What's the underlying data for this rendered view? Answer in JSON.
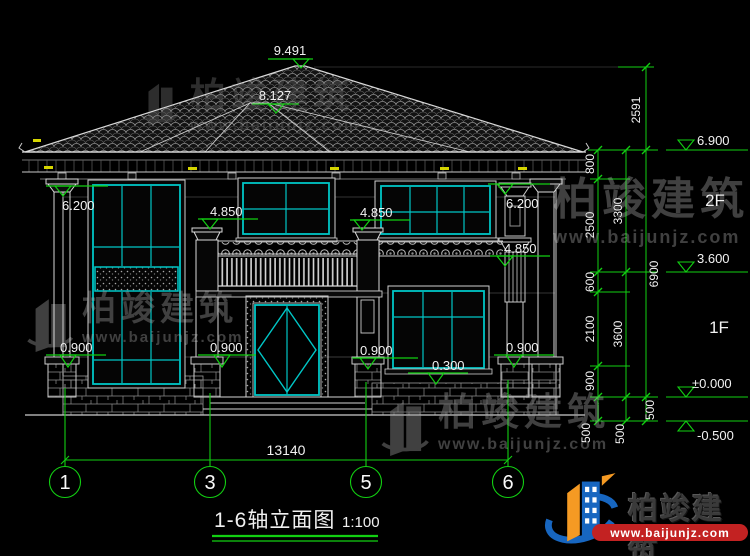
{
  "colors": {
    "background": "#000000",
    "line_white": "#d9d9d9",
    "cad_green": "#12cf12",
    "cad_cyan": "#00c6c6",
    "cad_yellow": "#d6d600",
    "watermark_gray": "#4b4b4b",
    "logo_red": "#c32222",
    "logo_blue": "#1766c0",
    "logo_orange": "#f59a23"
  },
  "roof_markers": {
    "ridge": "9.491",
    "porch_ridge": "8.127"
  },
  "level_markers": {
    "eave_left": "6.200",
    "eave_right": "6.200",
    "balcony_left": "4.850",
    "balcony_mid": "4.850",
    "balcony_right": "4.850",
    "base_1": "0.900",
    "base_2": "0.900",
    "base_3": "0.900",
    "base_4": "0.900",
    "sill": "0.300"
  },
  "right_dims": {
    "roof_height": "2591",
    "col1": [
      "800",
      "2500",
      "600",
      "2100",
      "900",
      "500"
    ],
    "col2": [
      "3300",
      "3600",
      "500"
    ],
    "col3": [
      "6900",
      "500"
    ],
    "levels": {
      "eave": "6.900",
      "floor2": "3.600",
      "zero": "±0.000",
      "ground": "-0.500"
    },
    "floors": {
      "second": "2F",
      "first": "1F"
    }
  },
  "bottom": {
    "overall": "13140",
    "axes": [
      "1",
      "3",
      "5",
      "6"
    ]
  },
  "title": {
    "name": "1-6轴立面图",
    "scale": "1:100"
  },
  "watermark": {
    "name": "柏竣建筑",
    "site": "www.baijunjz.com"
  },
  "logo": {
    "name": "柏竣建筑",
    "site": "www.baijunjz.com"
  }
}
